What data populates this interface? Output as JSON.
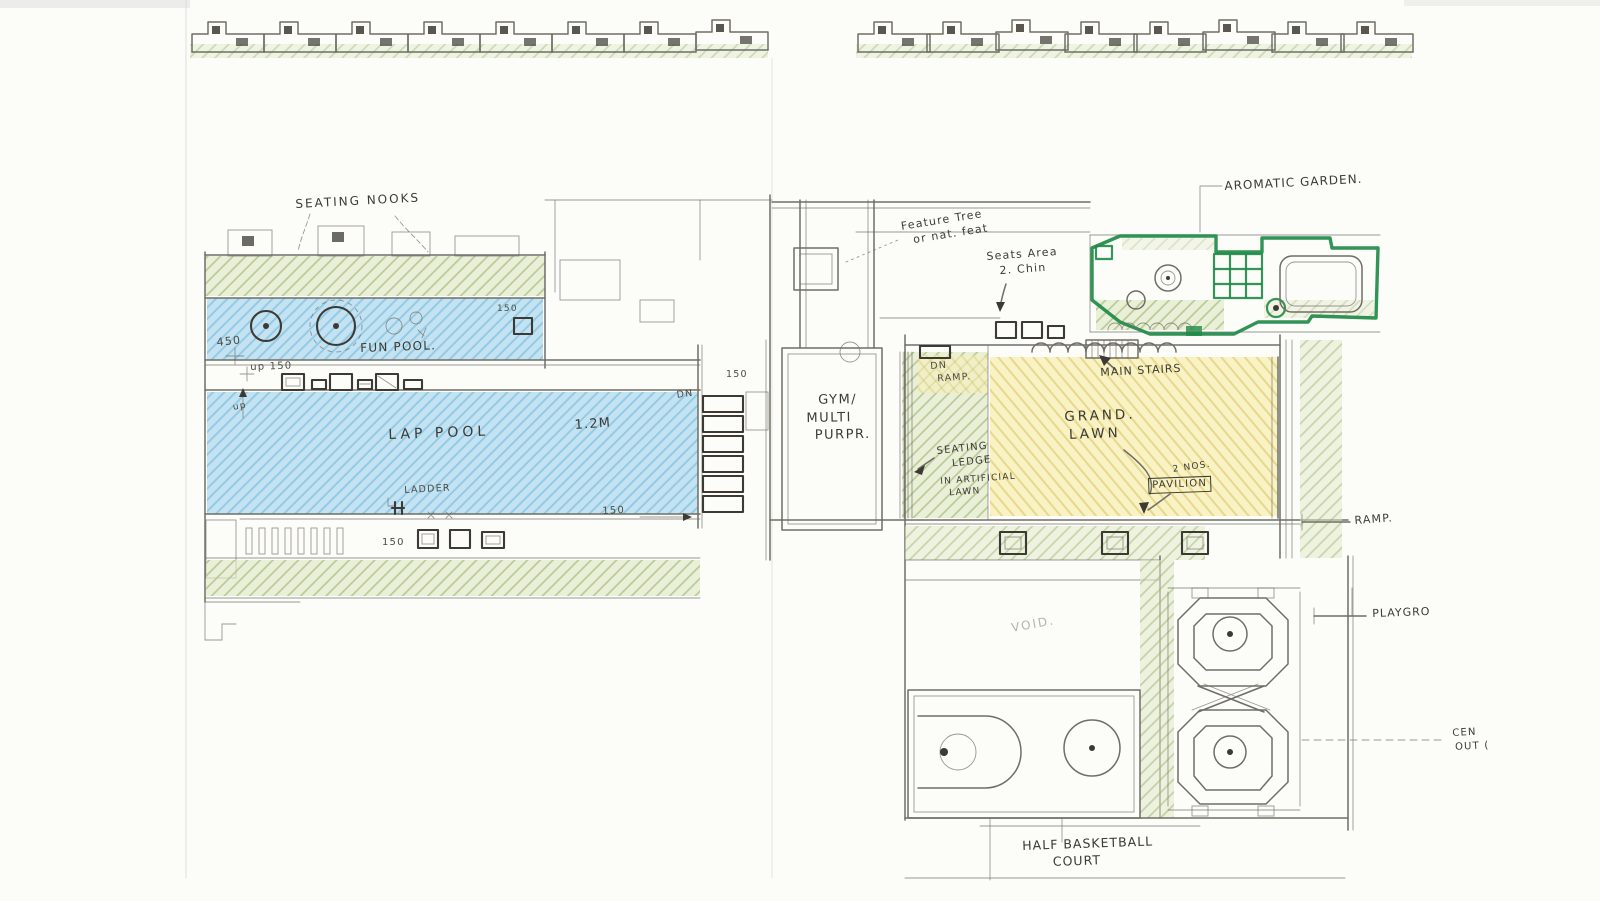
{
  "colors": {
    "paper": "#fcfcf9",
    "pencil": "#6f6e66",
    "ink": "#3c3a33",
    "dim": "#4c4b44",
    "faint": "#b6b5ab",
    "pool_blue": "#c3e3f2",
    "pool_stroke": "#8ac4e2",
    "green_fill": "#e0e9c6",
    "green_stroke": "#a6bf82",
    "yellow_fill": "#f7f0bc",
    "yellow_stroke": "#e6d584",
    "marker_green": "#1f8a46",
    "pink_fill": "#f0c8c2",
    "gray_fill": "#eaeae5"
  },
  "labels": {
    "seating_nooks": "SEATING NOOKS",
    "fun_pool": "FUN POOL.",
    "lap_pool": "LAP POOL",
    "pool_depth": "1.2M",
    "ladder": "LADDER",
    "gym": [
      "GYM/",
      "MULTI",
      "PURPR."
    ],
    "feature_tree": [
      "Feature Tree",
      "or nat. feat"
    ],
    "seats_note": [
      "Seats Area",
      "2. Chin"
    ],
    "aromatic_garden": "AROMATIC GARDEN.",
    "main_stairs": "MAIN STAIRS",
    "dn_ramp": [
      "DN",
      "RAMP."
    ],
    "grand_lawn": [
      "GRAND.",
      "LAWN"
    ],
    "seating_ledge": [
      "SEATING",
      "LEDGE"
    ],
    "artificial_lawn": [
      "IN ARTIFICIAL",
      "LAWN"
    ],
    "pavilion_qty": "2 NOS.",
    "pavilion": "PAVILION",
    "ramp": "RAMP.",
    "void": "VOID.",
    "playground": "PLAYGRO",
    "central_outdoor": [
      "CEN",
      "OUT ("
    ],
    "half_court": [
      "HALF BASKETBALL",
      "COURT"
    ]
  },
  "dimensions": {
    "d450": "450",
    "up150": "up 150",
    "up": "up",
    "d150_funpool": "150",
    "d150_poolend": "150",
    "d150_bench": "150",
    "d150_stair": "150",
    "dn": "DN"
  }
}
